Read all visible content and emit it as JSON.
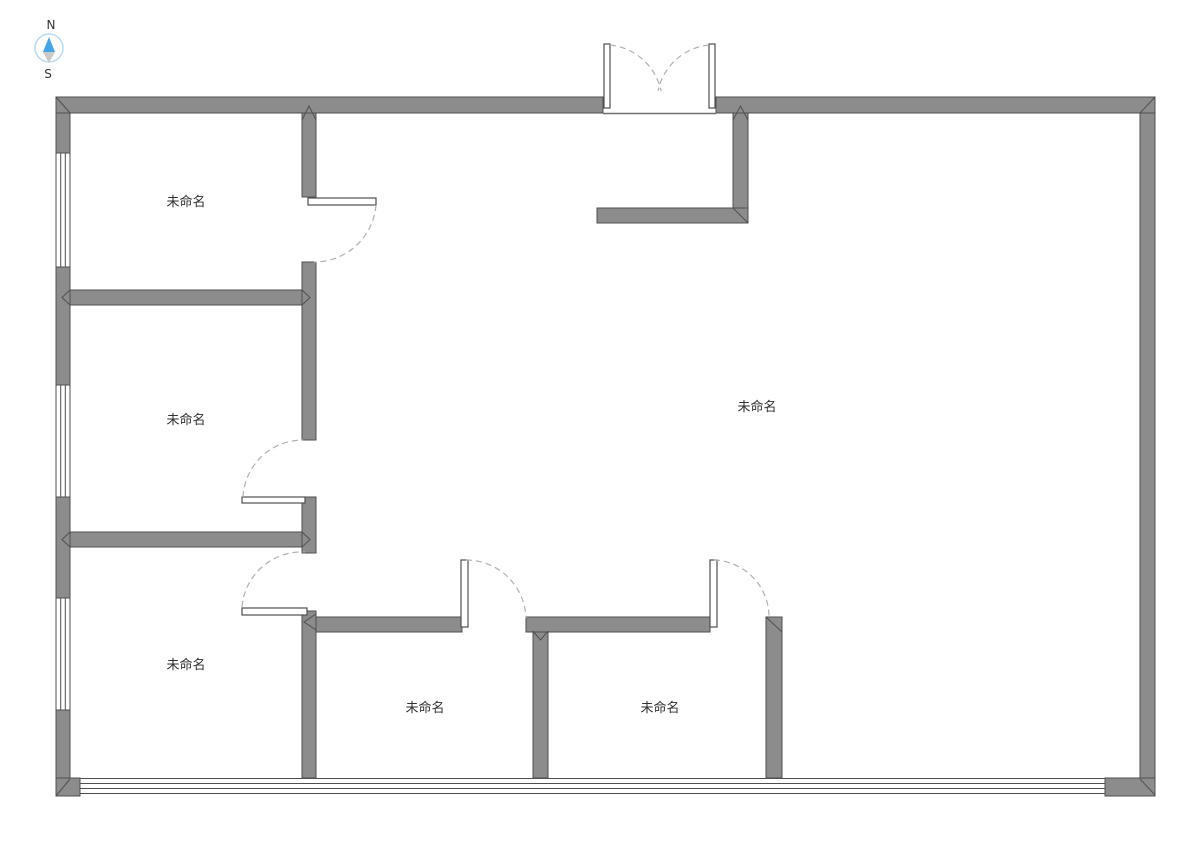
{
  "compass": {
    "north_label": "N",
    "south_label": "S"
  },
  "rooms": [
    {
      "name": "未命名",
      "x": 186,
      "y": 206
    },
    {
      "name": "未命名",
      "x": 186,
      "y": 424
    },
    {
      "name": "未命名",
      "x": 757,
      "y": 411
    },
    {
      "name": "未命名",
      "x": 186,
      "y": 669
    },
    {
      "name": "未命名",
      "x": 425,
      "y": 712
    },
    {
      "name": "未命名",
      "x": 660,
      "y": 712
    }
  ],
  "colors": {
    "wall_fill": "#8c8c8c",
    "wall_outline": "#4f4f4f",
    "door_arc": "#b3b0ae",
    "compass_north": "#41a5e7",
    "compass_south": "#c9c9c9",
    "compass_ring": "#b5d9f0",
    "label_text": "#2f2f2f"
  }
}
